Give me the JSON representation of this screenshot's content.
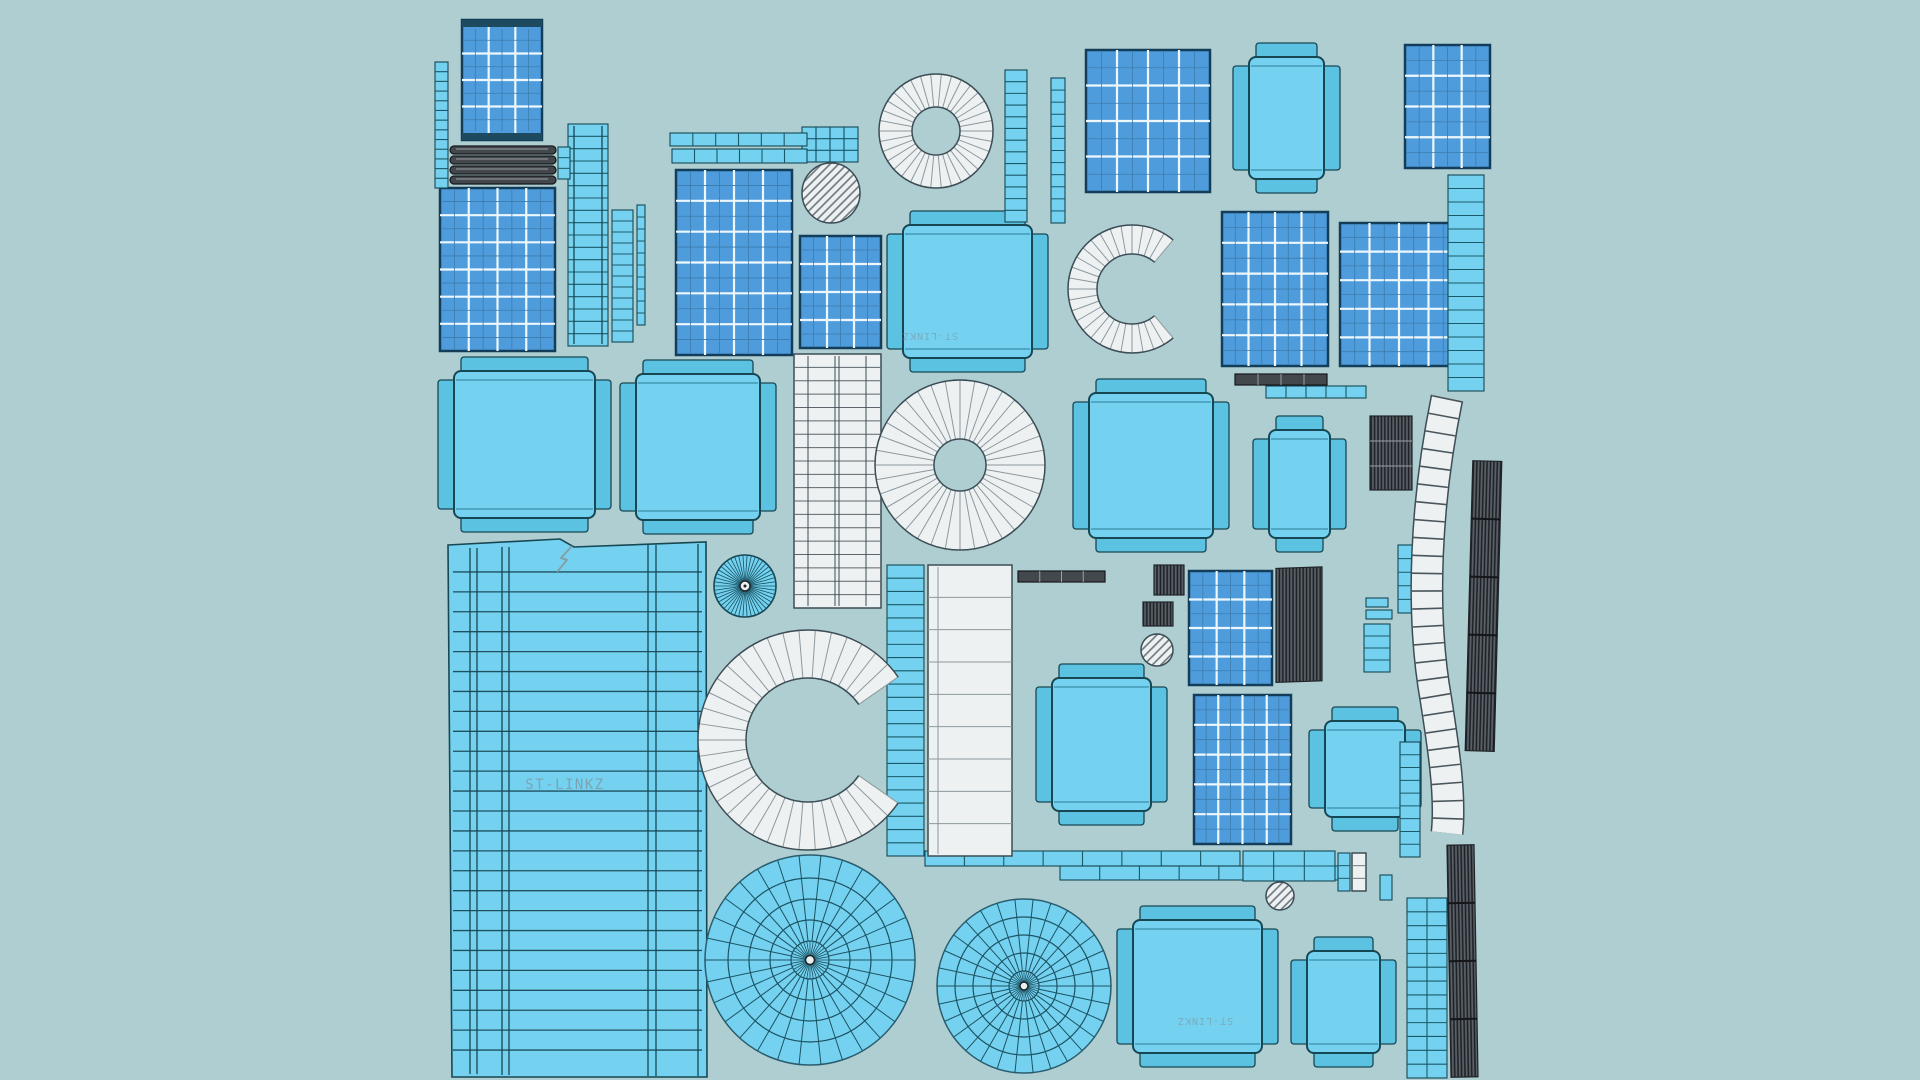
{
  "scene": {
    "description": "UV-unwrap texture atlas screenshot of the ST-LINKZ 3D model: wireframe islands (solar panel grids, module faces, rings, fans, strips) laid out on a plain teal background",
    "model_label": "ST-LINKZ"
  },
  "labels": {
    "main": "ST-LINKZ",
    "module_top": "ST-LINKZ",
    "module_bottom": "ST-LINKZ"
  },
  "palette": {
    "bg": "#aeced2",
    "cyan": "#74d2f0",
    "cyanBand": "#5cc2e2",
    "outline": "#174753",
    "panelBlue": "#4f9cdd",
    "panelLine": "#eef7fb",
    "panelSub": "#3c7cab",
    "panelBorder": "#143d5a",
    "white": "#edf1f2",
    "whiteLine": "#707a80",
    "whiteOutline": "#3c4d55",
    "dark": "#43484d",
    "darkLine": "#9aa1a7",
    "darkDeep": "#15181b",
    "hatch": "#6a747b",
    "text": "#7f98a3"
  },
  "counts": {
    "solar_panel_grids": 10,
    "cyan_modules": 10,
    "white_donut_rings": 2,
    "white_c_arcs": 2,
    "radial_fan_discs": 2,
    "hatched_circles": 3
  },
  "islands": [
    {
      "name": "ladder-strip-a",
      "kind": "cyan-ladder-strip"
    },
    {
      "name": "solar-panel-tall",
      "kind": "solar-panel-grid"
    },
    {
      "name": "dark-pill-bars",
      "kind": "dark-striped-bars"
    },
    {
      "name": "solar-panel-left-large",
      "kind": "solar-panel-grid"
    },
    {
      "name": "tapered-ladder-wide",
      "kind": "cyan-ladder-strip"
    },
    {
      "name": "ladder-strip-b",
      "kind": "cyan-ladder-strip"
    },
    {
      "name": "plain-strip",
      "kind": "cyan-strip"
    },
    {
      "name": "h-strips-top",
      "kind": "cyan-segmented-strips"
    },
    {
      "name": "solar-panel-mid",
      "kind": "solar-panel-grid"
    },
    {
      "name": "small-grid-cyan",
      "kind": "cyan-cell-grid"
    },
    {
      "name": "hatch-circle-a",
      "kind": "hatched-circle"
    },
    {
      "name": "solar-panel-small-a",
      "kind": "solar-panel-grid"
    },
    {
      "name": "white-donut-small",
      "kind": "white-donut-ring"
    },
    {
      "name": "ladder-strip-c",
      "kind": "cyan-ladder-strip"
    },
    {
      "name": "ladder-strip-d",
      "kind": "cyan-ladder-strip"
    },
    {
      "name": "module-top-center",
      "kind": "cyan-module-face",
      "label_rotated": "ST-LINKZ"
    },
    {
      "name": "c-arc-top",
      "kind": "white-c-arc"
    },
    {
      "name": "solar-panel-top-right",
      "kind": "solar-panel-grid"
    },
    {
      "name": "module-top-right",
      "kind": "cyan-module-face"
    },
    {
      "name": "solar-panel-top-far-right",
      "kind": "solar-panel-grid"
    },
    {
      "name": "tapered-strip-right",
      "kind": "cyan-ladder-strip"
    },
    {
      "name": "solar-panel-right-a",
      "kind": "solar-panel-grid"
    },
    {
      "name": "solar-panel-right-b",
      "kind": "solar-panel-grid"
    },
    {
      "name": "dark-strip-h-a",
      "kind": "dark-segmented-strip"
    },
    {
      "name": "strip-h-cyan",
      "kind": "cyan-segmented-strip"
    },
    {
      "name": "module-a",
      "kind": "cyan-module-face"
    },
    {
      "name": "module-b",
      "kind": "cyan-module-face"
    },
    {
      "name": "white-striped-panel",
      "kind": "white-striped-band"
    },
    {
      "name": "white-donut-large",
      "kind": "white-donut-ring"
    },
    {
      "name": "module-c",
      "kind": "cyan-module-face"
    },
    {
      "name": "module-d",
      "kind": "cyan-module-face"
    },
    {
      "name": "dark-hatch-bar-a",
      "kind": "dark-hatched-bar"
    },
    {
      "name": "white-curved-band-right",
      "kind": "white-ladder-band"
    },
    {
      "name": "dark-hatch-bar-b",
      "kind": "dark-hatched-bar"
    },
    {
      "name": "dark-hatch-bar-c",
      "kind": "dark-hatched-bar"
    },
    {
      "name": "big-striped-panel",
      "kind": "cyan-striped-panel",
      "label": "ST-LINKZ"
    },
    {
      "name": "radial-disc-small",
      "kind": "cyan-radial-disc"
    },
    {
      "name": "c-arc-large",
      "kind": "white-c-arc"
    },
    {
      "name": "cyan-curved-band",
      "kind": "cyan-ladder-band"
    },
    {
      "name": "white-band-tall",
      "kind": "white-band"
    },
    {
      "name": "dark-strip-h-b",
      "kind": "dark-segmented-strip"
    },
    {
      "name": "dark-mini-grid-a",
      "kind": "dark-striped-square"
    },
    {
      "name": "dark-mini-grid-b",
      "kind": "dark-striped-square"
    },
    {
      "name": "hatch-circle-b",
      "kind": "hatched-circle"
    },
    {
      "name": "solar-panel-small-b",
      "kind": "solar-panel-grid"
    },
    {
      "name": "dark-vstripe-panel",
      "kind": "dark-hatched-bar"
    },
    {
      "name": "module-e",
      "kind": "cyan-module-face"
    },
    {
      "name": "solar-panel-small-c",
      "kind": "solar-panel-grid"
    },
    {
      "name": "module-f",
      "kind": "cyan-module-face"
    },
    {
      "name": "tiny-strips",
      "kind": "cyan-strips"
    },
    {
      "name": "h-strip-long-a",
      "kind": "cyan-segmented-strip"
    },
    {
      "name": "h-strip-long-b",
      "kind": "cyan-segmented-strip"
    },
    {
      "name": "h-strip-wide",
      "kind": "cyan-cell-strip"
    },
    {
      "name": "strip-pair-bottom",
      "kind": "mixed-strip-pair"
    },
    {
      "name": "hatch-circle-c",
      "kind": "hatched-circle"
    },
    {
      "name": "fan-large",
      "kind": "cyan-radial-fan"
    },
    {
      "name": "fan-medium",
      "kind": "cyan-radial-fan"
    },
    {
      "name": "module-bottom-a",
      "kind": "cyan-module-face",
      "label_rotated": "ST-LINKZ"
    },
    {
      "name": "module-bottom-b",
      "kind": "cyan-module-face"
    },
    {
      "name": "ladder-bottom-right",
      "kind": "cyan-ladder-grid"
    },
    {
      "name": "ladder-right-mid",
      "kind": "cyan-ladder-strip"
    }
  ]
}
